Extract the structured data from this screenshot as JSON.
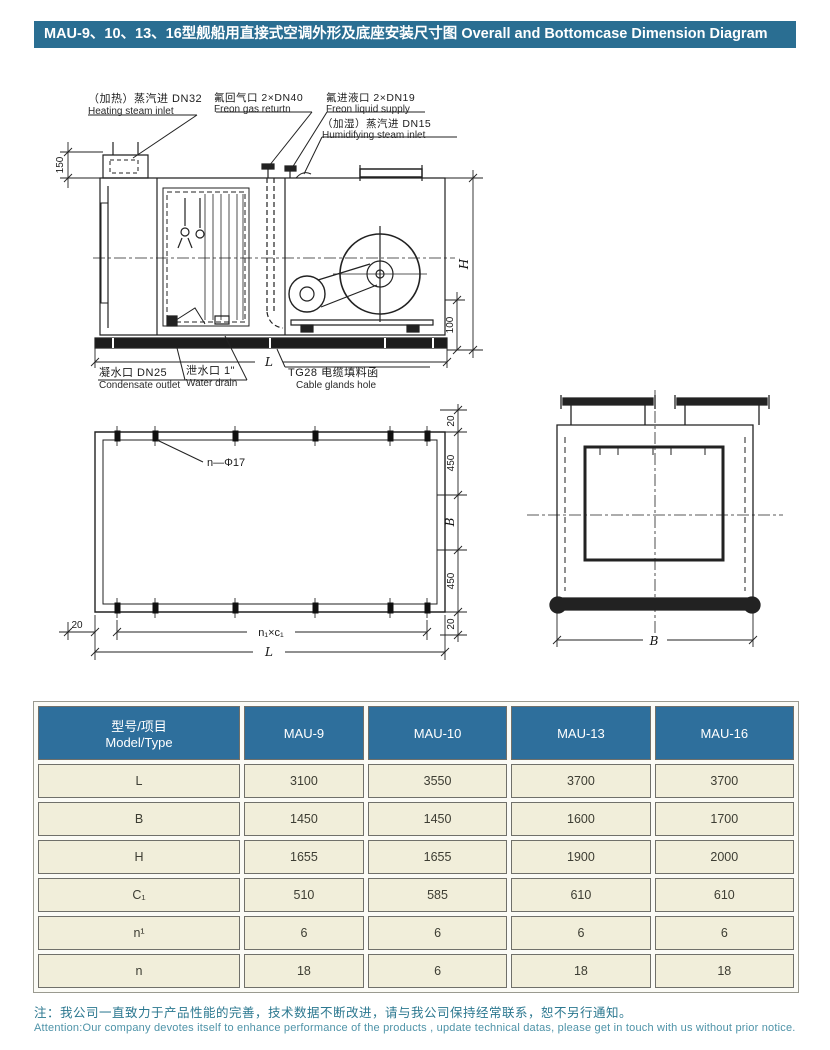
{
  "title": "MAU-9、10、13、16型舰船用直接式空调外形及底座安装尺寸图 Overall and Bottomcase Dimension Diagram",
  "colors": {
    "title_bg": "#2a6e92",
    "table_header_bg": "#2e6f9c",
    "cell_bg": "#f1eeda",
    "note_zh": "#2c7890",
    "note_en": "#4e93a8"
  },
  "labels": {
    "heating": {
      "zh": "（加热）蒸汽进 DN32",
      "en": "Heating steam inlet"
    },
    "freon_gas": {
      "zh": "氟回气口 2×DN40",
      "en": "Freon gas returtn"
    },
    "freon_liquid": {
      "zh": "氟进液口 2×DN19",
      "en": "Freon liquid supply"
    },
    "humidifying": {
      "zh": "（加湿）蒸汽进 DN15",
      "en": "Humidifying steam inlet"
    },
    "condensate": {
      "zh": "凝水口 DN25",
      "en": "Condensate outlet"
    },
    "drain": {
      "zh": "泄水口 1\"",
      "en": "Water drain"
    },
    "cable": {
      "zh": "TG28 电缆填料函",
      "en": "Cable glands hole"
    }
  },
  "dims": {
    "h": "H",
    "hundred": "100",
    "one_fifty": "150",
    "l": "L",
    "twenty": "20",
    "four_fifty": "450",
    "b": "B",
    "n_phi": "n—Φ17",
    "n1c1": "n₁×c₁"
  },
  "table": {
    "header": {
      "param_zh": "型号/项目",
      "param_en": "Model/Type",
      "models": [
        "MAU-9",
        "MAU-10",
        "MAU-13",
        "MAU-16"
      ]
    },
    "rows": [
      {
        "param": "L",
        "values": [
          "3100",
          "3550",
          "3700",
          "3700"
        ]
      },
      {
        "param": "B",
        "values": [
          "1450",
          "1450",
          "1600",
          "1700"
        ]
      },
      {
        "param": "H",
        "values": [
          "1655",
          "1655",
          "1900",
          "2000"
        ]
      },
      {
        "param": "C₁",
        "values": [
          "510",
          "585",
          "610",
          "610"
        ]
      },
      {
        "param": "n¹",
        "values": [
          "6",
          "6",
          "6",
          "6"
        ]
      },
      {
        "param": "n",
        "values": [
          "18",
          "6",
          "18",
          "18"
        ]
      }
    ]
  },
  "note": {
    "zh": "注：我公司一直致力于产品性能的完善，技术数据不断改进，请与我公司保持经常联系，恕不另行通知。",
    "en": "Attention:Our company devotes itself to enhance performance of the products , update technical datas, please get in touch with us without prior notice."
  }
}
